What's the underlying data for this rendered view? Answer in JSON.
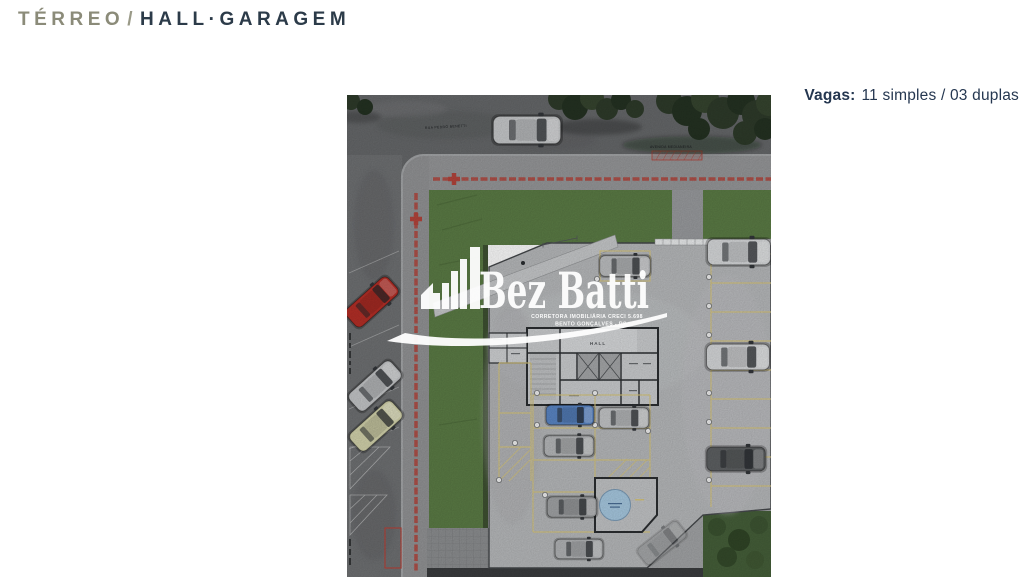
{
  "header": {
    "title_primary": "TÉRREO",
    "title_separator": "/",
    "title_secondary": "HALL·GARAGEM"
  },
  "info": {
    "vagas_label": "Vagas:",
    "vagas_value": "11 simples / 03 duplas"
  },
  "plan": {
    "street_top_label": "RUA PEDRO BENETTI",
    "street_right_label": "AVENIDA MEDIANEIRA",
    "building": {
      "hall_label": "HALL"
    },
    "watermark": {
      "brand": "Bez Batti",
      "tagline_line1": "CORRETORA IMOBILIÁRIA CRECI 5.698",
      "tagline_line2": "BENTO GONÇALVES - RS"
    }
  },
  "colors": {
    "accent_navy": "#253750",
    "accent_olive": "#8b8b79",
    "lawn": "#5c7d46",
    "slab": "#b9bbbd",
    "asphalt": "#67696b",
    "sidewalk": "#98999b",
    "property_line_red": "#b5453c",
    "parking_line_yellow": "#d9c87e",
    "cistern_blue": "#a9cbe3",
    "watermark_white": "#ffffff",
    "vegetation": "#46603a"
  }
}
